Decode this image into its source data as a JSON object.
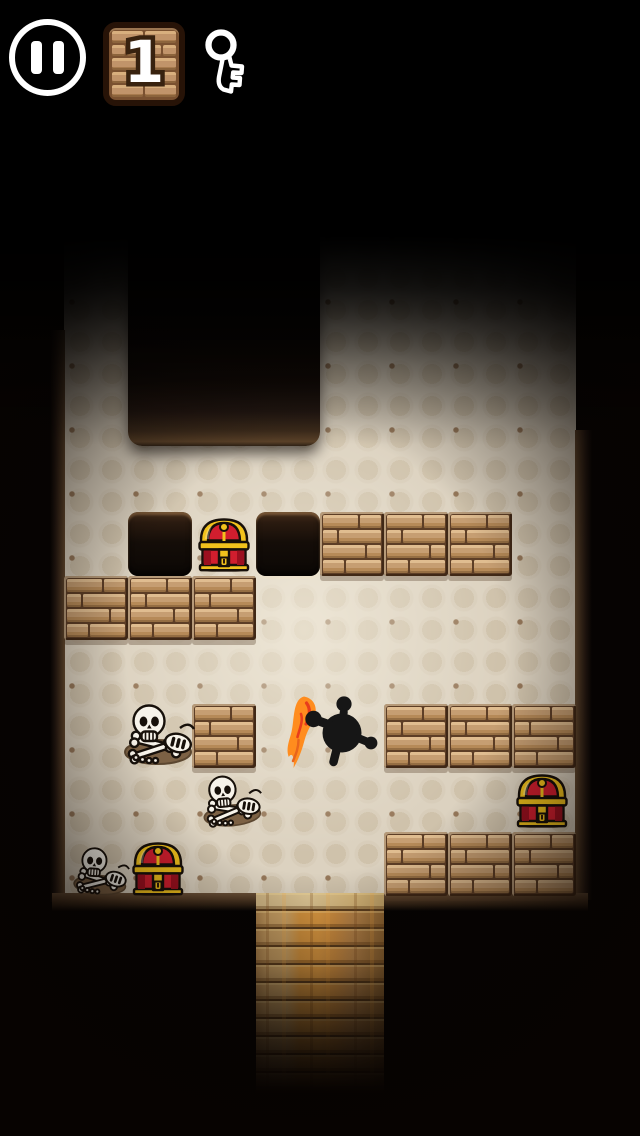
{
  "hud": {
    "pause_button": {
      "icon": "pause-icon"
    },
    "level_indicator": {
      "value": "1",
      "style": "brick-tile"
    },
    "key_indicator": {
      "icon": "key-icon",
      "state": "outline-no-key-collected"
    }
  },
  "palette": {
    "background": "#050302",
    "floor": "#dcd2c0",
    "floor_motif": "#cfc2ab",
    "mortar": "#5d3e26",
    "brick": "#c69e72",
    "brick_light": "#e0bd90",
    "dirt_edge": "#65492f",
    "pit": "#0b0705",
    "chest_red": "#d11e2e",
    "chest_red_dark": "#9c101f",
    "chest_gold": "#f2c21c",
    "bone": "#f7f3ea",
    "outline": "#17100a",
    "silhouette": "#161616",
    "flame_orange": "#ff8c1e",
    "flame_red": "#e83d1c",
    "bridge_wood": "#c59c61",
    "bridge_orange": "#d8963f",
    "hud_white": "#ffffff"
  },
  "board": {
    "tile_size": 64,
    "floor": {
      "x": 64,
      "y": 230,
      "w": 512,
      "h": 666
    },
    "top_pit": {
      "x": 128,
      "y": 230,
      "w": 192,
      "h": 216
    },
    "holes": [
      [
        128,
        512
      ],
      [
        256,
        512
      ]
    ],
    "brick_blocks": [
      [
        320,
        512
      ],
      [
        384,
        512
      ],
      [
        448,
        512
      ],
      [
        64,
        576
      ],
      [
        128,
        576
      ],
      [
        192,
        576
      ],
      [
        192,
        704
      ],
      [
        384,
        704
      ],
      [
        448,
        704
      ],
      [
        512,
        704
      ],
      [
        384,
        832
      ],
      [
        448,
        832
      ],
      [
        512,
        832
      ]
    ],
    "chests": [
      [
        196,
        514
      ],
      [
        514,
        770
      ],
      [
        130,
        838
      ]
    ],
    "skeletons": [
      [
        114,
        700,
        1,
        0
      ],
      [
        188,
        764,
        0.85,
        -5
      ],
      [
        56,
        834,
        0.78,
        4
      ]
    ],
    "player": {
      "x": 278,
      "y": 688,
      "w": 100,
      "h": 95,
      "holding": "torch-flame"
    },
    "bridge": {
      "x": 256,
      "y": 893,
      "w": 128,
      "h": 200
    }
  }
}
